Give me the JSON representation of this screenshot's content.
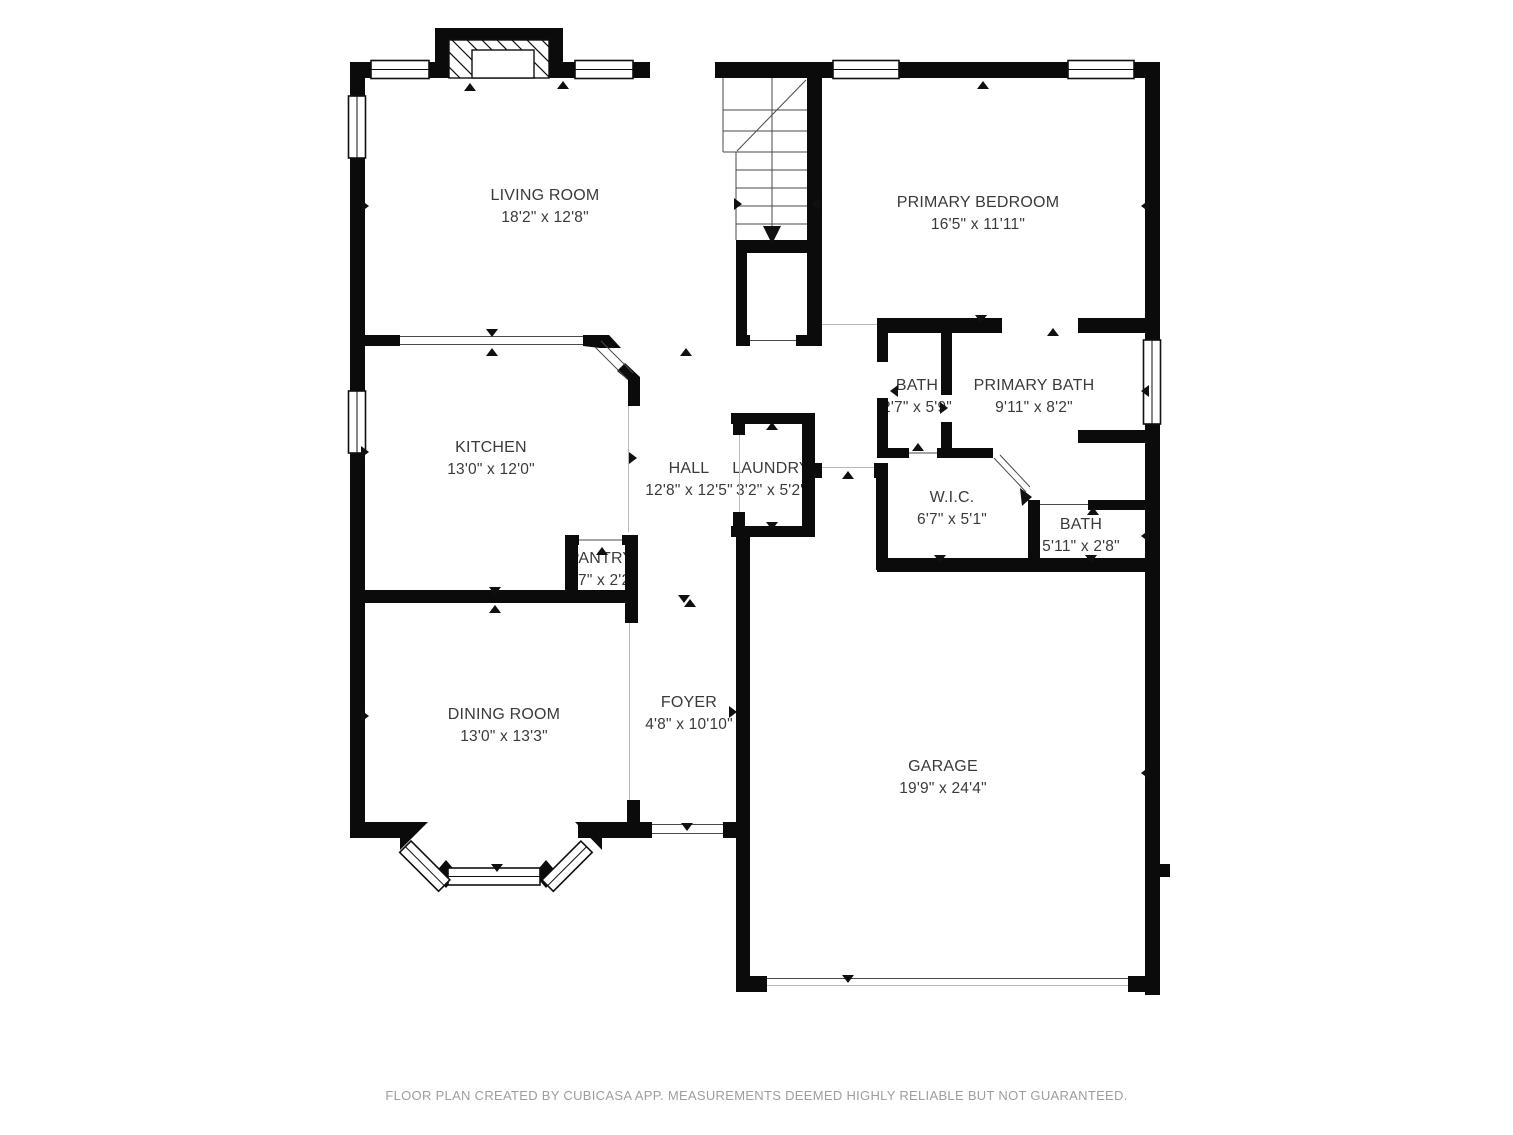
{
  "plan": {
    "type": "floor-plan",
    "source_note": "CubiCasa floor plan"
  },
  "rooms": {
    "living_room": {
      "name": "LIVING ROOM",
      "dims": "18'2\" x 12'8\""
    },
    "primary_bedroom": {
      "name": "PRIMARY BEDROOM",
      "dims": "16'5\" x 11'11\""
    },
    "kitchen": {
      "name": "KITCHEN",
      "dims": "13'0\" x 12'0\""
    },
    "hall": {
      "name": "HALL",
      "dims": "12'8\" x 12'5\""
    },
    "laundry": {
      "name": "LAUNDRY",
      "dims": "3'2\" x 5'2\""
    },
    "bath": {
      "name": "BATH",
      "dims": "2'7\" x 5'9\""
    },
    "primary_bath": {
      "name": "PRIMARY BATH",
      "dims": "9'11\" x 8'2\""
    },
    "wic": {
      "name": "W.I.C.",
      "dims": "6'7\" x 5'1\""
    },
    "bath_2": {
      "name": "BATH",
      "dims": "5'11\" x 2'8\""
    },
    "pantry": {
      "name": "PANTRY",
      "dims": "4'7\" x 2'2\""
    },
    "dining_room": {
      "name": "DINING ROOM",
      "dims": "13'0\" x 13'3\""
    },
    "foyer": {
      "name": "FOYER",
      "dims": "4'8\" x 10'10\""
    },
    "garage": {
      "name": "GARAGE",
      "dims": "19'9\" x 24'4\""
    }
  },
  "footer": {
    "text": "FLOOR PLAN CREATED BY CUBICASA APP. MEASUREMENTS DEEMED HIGHLY RELIABLE BUT NOT GUARANTEED."
  },
  "colors": {
    "wall": "#0b0b0b",
    "label_text": "#3a3a3a",
    "footer_text": "#9e9e9e",
    "background": "#ffffff"
  }
}
